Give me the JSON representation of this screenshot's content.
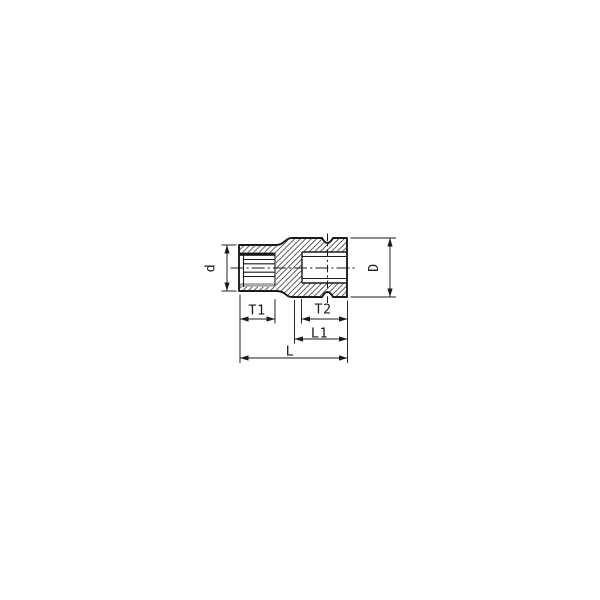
{
  "page": {
    "background_color": "#ffffff",
    "description": "Technical cross-section line drawing of a 12-point socket wrench insert with dimension callouts"
  },
  "drawing": {
    "stroke_color": "#1b1b1b",
    "hatch_color": "#4f4f4f",
    "bore_top_shade_color": "#141414",
    "bore_bottom_shade_color": "#a8a8a8",
    "labels": {
      "d": "d",
      "D": "D",
      "T1": "T1",
      "T2": "T2",
      "L1": "L1",
      "L": "L"
    }
  }
}
